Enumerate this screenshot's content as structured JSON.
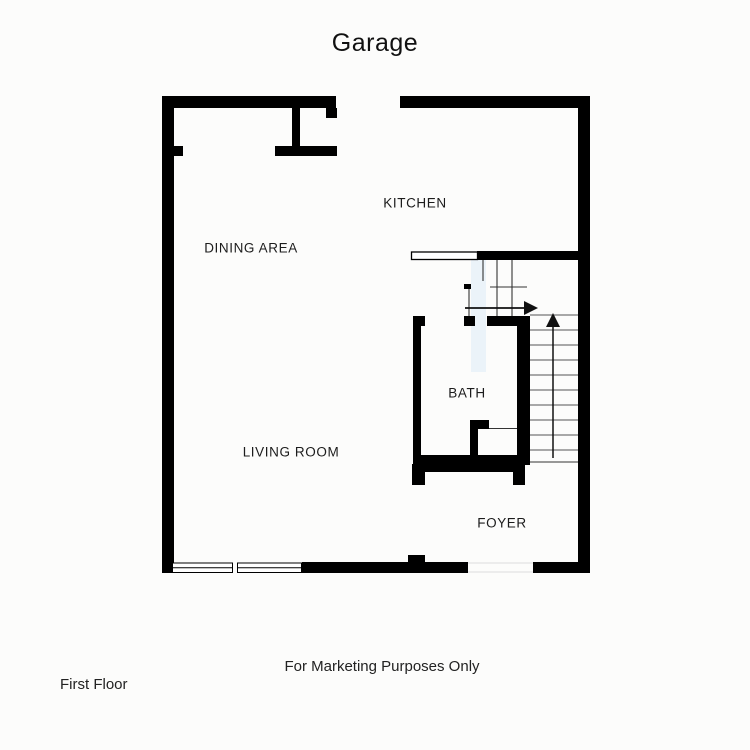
{
  "title": "Garage",
  "rooms": {
    "kitchen": "KITCHEN",
    "dining_area": "DINING AREA",
    "living_room": "LIVING ROOM",
    "bath": "BATH",
    "foyer": "FOYER"
  },
  "footer": {
    "marketing_note": "For Marketing Purposes Only",
    "floor_label": "First Floor"
  },
  "icons": {
    "stairs_up": "arrow-up",
    "stairs_turn": "arrow-right"
  },
  "colors": {
    "background": "#fcfcfb",
    "wall": "#000000",
    "stair_tread_line": "#555555",
    "thin_line": "#333333",
    "bath_door_highlight": "#e8f1f8",
    "text": "#1a1a1a"
  }
}
